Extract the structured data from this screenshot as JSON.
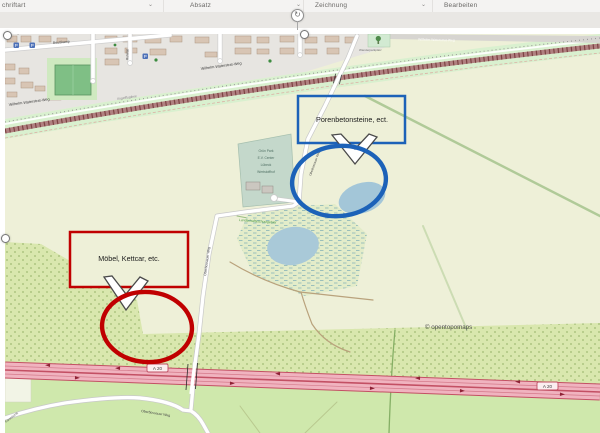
{
  "ribbon": {
    "groups": [
      {
        "label": "chriftart"
      },
      {
        "label": "Absatz"
      },
      {
        "label": "Zeichnung"
      },
      {
        "label": "Bearbeiten"
      }
    ]
  },
  "icons": {
    "dialog_launcher": "⌄",
    "rotate": "↻",
    "parking": "P"
  },
  "callouts": {
    "blue": {
      "label": "Porenbetonsteine, ect.",
      "color": "#1c62b8"
    },
    "red": {
      "label": "Möbel, Kettcar, etc.",
      "color": "#c00000"
    }
  },
  "map": {
    "attribution": "© opentopomaps",
    "motorway_badge": "A 20",
    "streets": {
      "wilhelm": "Wilhelm-Waterstrat-Weg",
      "beusskamp": "Beußkamp",
      "ruhetal": "Ruhetal",
      "oberbuessauer": "Oberbüssauer Weg",
      "farenhorst": "Farenhorst",
      "railway_name": "Vogelfluglinie"
    },
    "areas": {
      "protected": "Landschaftsschutzgebiet",
      "poi": "Wanderparkplatz",
      "facility_lines": [
        "Grün Park",
        "E.V. Center",
        "Lübeck",
        "Wertstoffhof"
      ]
    }
  }
}
